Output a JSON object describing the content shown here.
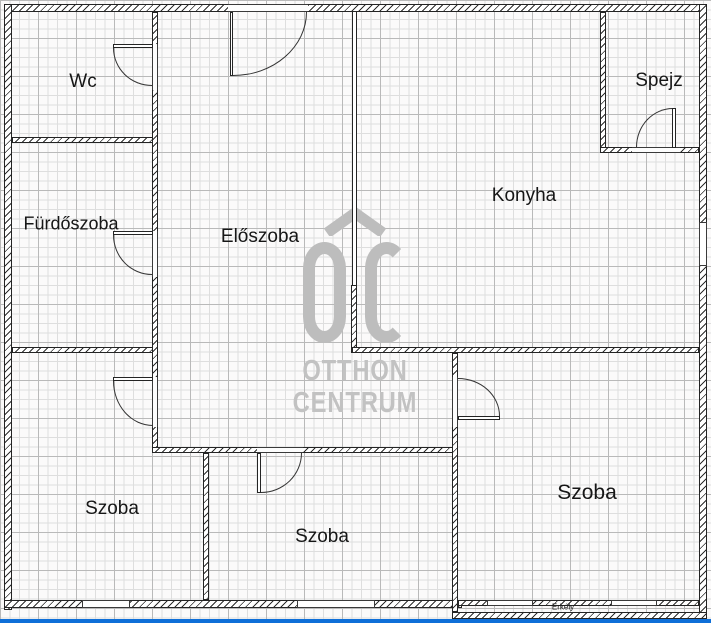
{
  "plan_title": "apartment-floor-plan",
  "rooms": [
    {
      "name": "wc",
      "label": "Wc"
    },
    {
      "name": "furdoszoba",
      "label": "Fürdőszoba"
    },
    {
      "name": "eloszoba",
      "label": "Előszoba"
    },
    {
      "name": "konyha",
      "label": "Konyha"
    },
    {
      "name": "spejz",
      "label": "Spejz"
    },
    {
      "name": "szoba-bottom-left",
      "label": "Szoba"
    },
    {
      "name": "szoba-middle",
      "label": "Szoba"
    },
    {
      "name": "szoba-bottom-right",
      "label": "Szoba"
    },
    {
      "name": "erkely",
      "label": "Erkély"
    }
  ],
  "watermark": {
    "line1": "OTTHON",
    "line2": "CENTRUM",
    "initials": "OC"
  },
  "colors": {
    "wall": "#2e2e2e",
    "grid_minor": "#dedede",
    "grid_major": "#b9b9b9",
    "watermark_gray": "#bdbdbd",
    "accent_bar_blue": "#0f6fd8",
    "label_text": "#161616"
  }
}
